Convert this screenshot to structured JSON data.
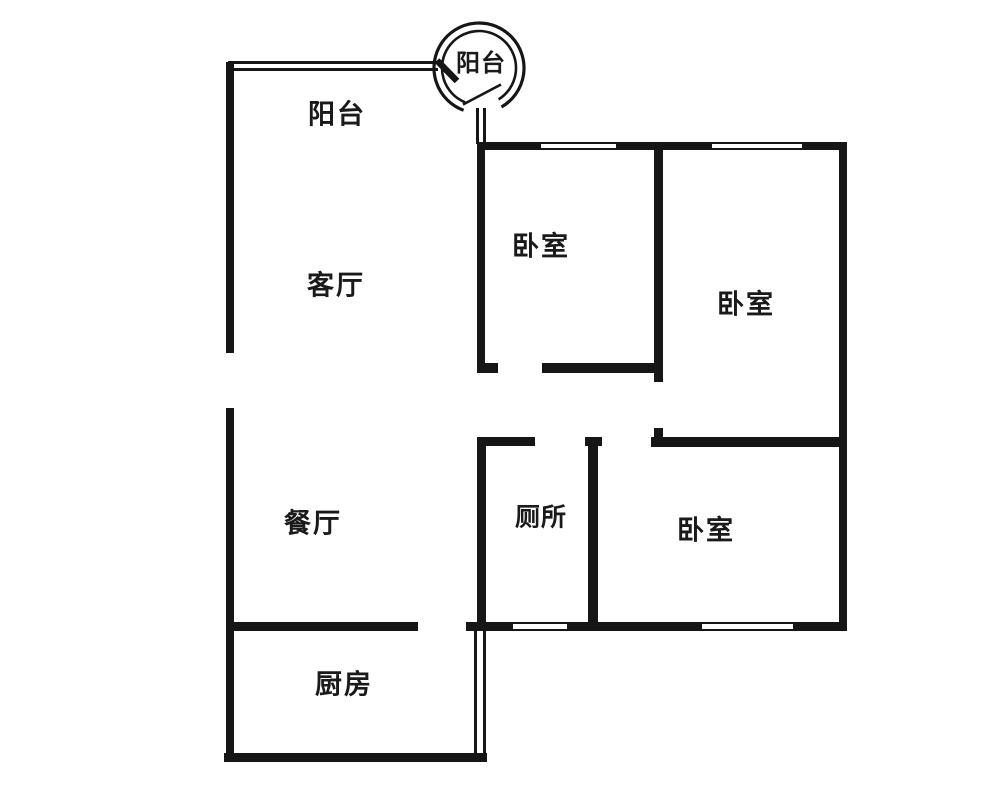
{
  "rooms": {
    "balcony_round": "阳台",
    "balcony": "阳台",
    "living": "客厅",
    "bedroom1": "卧室",
    "bedroom2": "卧室",
    "dining": "餐厅",
    "toilet": "厕所",
    "bedroom3": "卧室",
    "kitchen": "厨房"
  },
  "colors": {
    "wall": "#161616",
    "background": "#ffffff",
    "text": "#1a1a1a"
  }
}
